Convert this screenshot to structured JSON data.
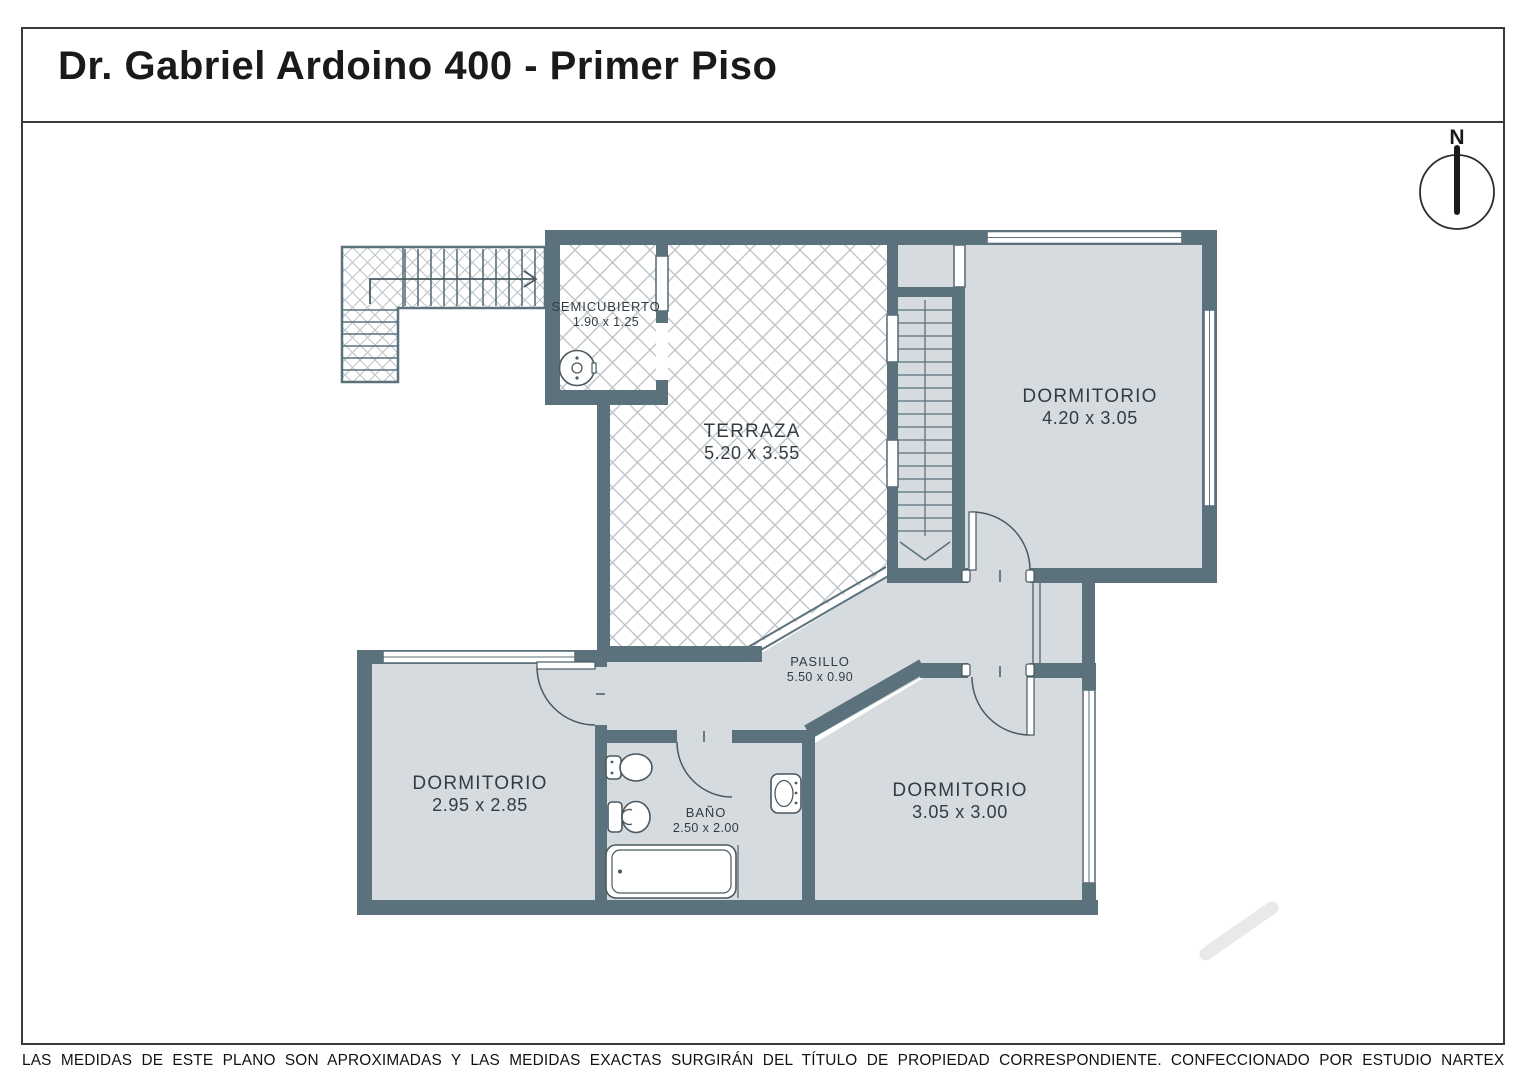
{
  "title": "Dr. Gabriel Ardoino 400 - Primer Piso",
  "compass": {
    "north": "N"
  },
  "rooms": {
    "semicubierto": {
      "name": "SEMICUBIERTO",
      "dims": "1.90 x 1.25"
    },
    "terraza": {
      "name": "TERRAZA",
      "dims": "5.20 x 3.55"
    },
    "dormitorio_noreste": {
      "name": "DORMITORIO",
      "dims": "4.20 x 3.05"
    },
    "pasillo": {
      "name": "PASILLO",
      "dims": "5.50 x 0.90"
    },
    "dormitorio_suroeste": {
      "name": "DORMITORIO",
      "dims": "2.95 x 2.85"
    },
    "bano": {
      "name": "BAÑO",
      "dims": "2.50 x 2.00"
    },
    "dormitorio_sureste": {
      "name": "DORMITORIO",
      "dims": "3.05 x 3.00"
    }
  },
  "footer": {
    "disclaimer": "LAS MEDIDAS  DE ESTE PLANO SON APROXIMADAS Y LAS MEDIDAS EXACTAS SURGIRÁN DEL TÍTULO DE PROPIEDAD CORRESPONDIENTE.",
    "credit": "CONFECCIONADO POR ESTUDIO NARTEX"
  },
  "colors": {
    "wall": "#5b717b",
    "floor": "#d5dbde",
    "hatch": "#bdc5c9"
  }
}
